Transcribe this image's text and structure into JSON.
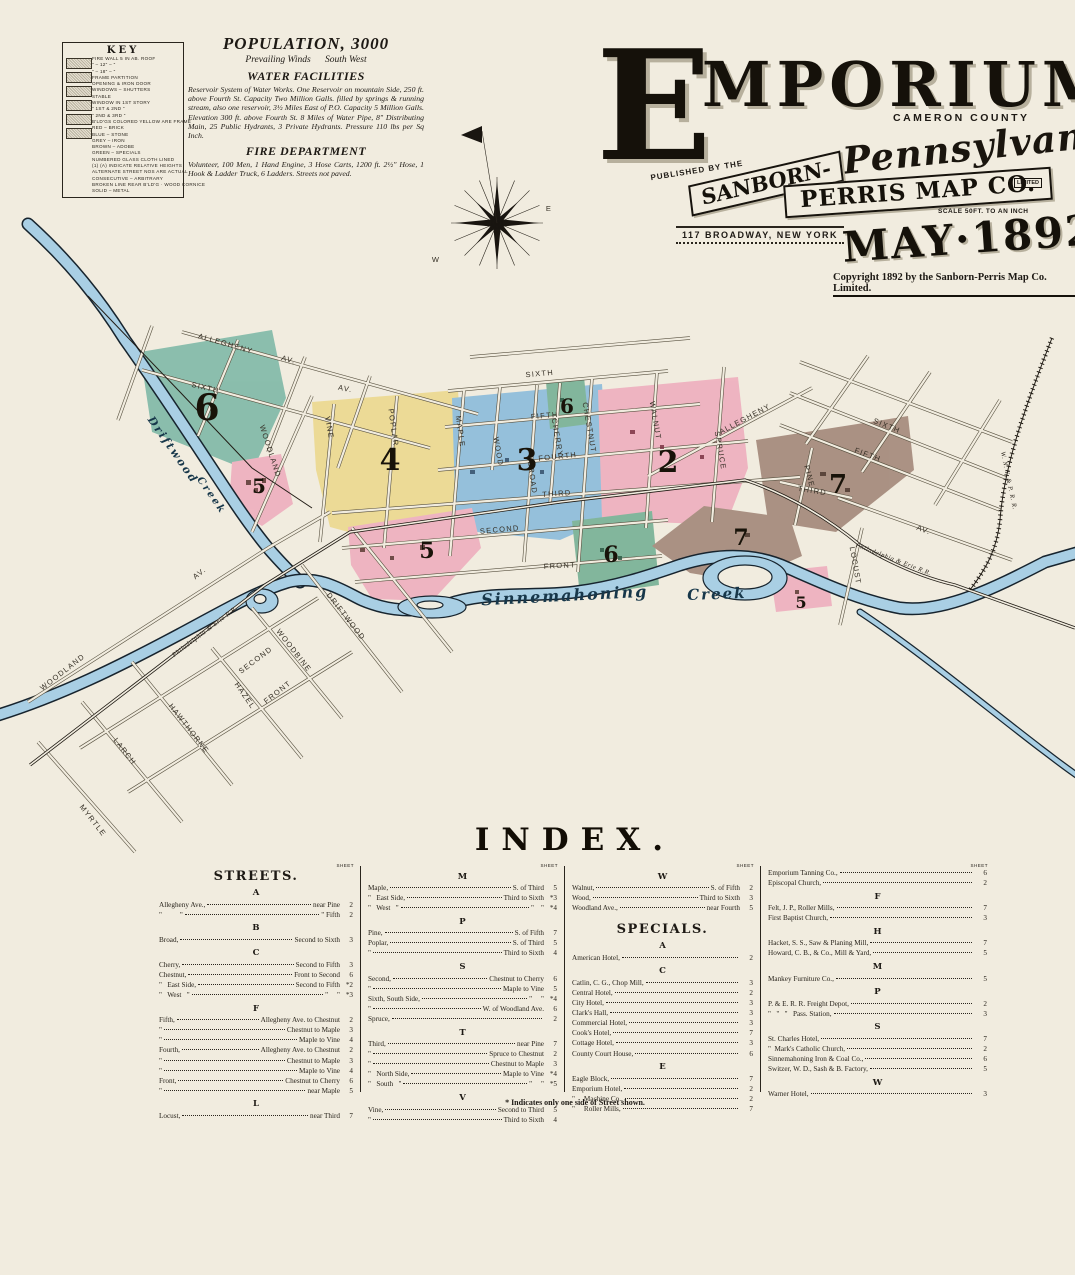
{
  "colors": {
    "paper": "#f1ecdf",
    "teal_district": "#7fb9a7",
    "yellow_district": "#ecd98f",
    "blue_district": "#8cbcdb",
    "pink_district": "#eeafbe",
    "green_district": "#76b195",
    "brown_district": "#a3887a",
    "river_fill": "#a9cfe4",
    "river_outline": "#17242e",
    "street_line": "#57503f",
    "ink": "#1d1914"
  },
  "key": {
    "title": "KEY",
    "lines": [
      "FIRE WALL 5 IN AB. ROOF",
      "\"   –   12\"   –   \"",
      "\"   –   18\"   –   \"",
      "FRAME PARTITION",
      "OPENING & IRON DOOR",
      "WINDOWS  –  SHUTTERS",
      "STABLE",
      "WINDOW IN 1ST STORY",
      "\"   1ST & 2ND   \"",
      "\"   2ND & 3RD   \"",
      "B'LD'GS COLORED YELLOW ARE FRAME",
      "RED   –   BRICK",
      "BLUE   –   STONE",
      "GREY   –   IRON",
      "BROWN   –   ADOBE",
      "GREEN   –   SPECIALS",
      "NUMBERED GLASS CLOTH LINED",
      "(1) (A) INDICATE RELATIVE HEIGHTS",
      "ALTERNATE STREET NOS ARE ACTUAL",
      "CONSECUTIVE   –   ARBITRARY",
      "BROKEN LINE REAR B'LD'G · WOOD CORNICE",
      "SOLID   –   METAL"
    ]
  },
  "info": {
    "population": "POPULATION, 3000",
    "winds": "Prevailing Winds      South West",
    "water_title": "WATER FACILITIES",
    "water_text": "Reservoir System of Water Works. One Reservoir on mountain Side, 250 ft. above Fourth St. Capacity Two Million Galls. filled by springs & running stream, also one reservoir, 3½ Miles East of P.O. Capacity 5 Million Galls. Elevation 300 ft. above Fourth St. 8 Miles of Water Pipe, 8\" Distributing Main, 25 Public Hydrants, 3 Private Hydrants. Pressure 110 lbs per Sq Inch.",
    "fire_title": "FIRE DEPARTMENT",
    "fire_text": "Volunteer, 100 Men, 1 Hand Engine, 3 Hose Carts, 1200 ft. 2½\" Hose, 1 Hook & Ladder Truck, 6 Ladders. Streets not paved."
  },
  "title_block": {
    "city_initial": "E",
    "city_rest": "MPORIUM",
    "county": "CAMERON COUNTY",
    "state": "Pennsylvania",
    "published_by": "PUBLISHED BY THE",
    "publisher_top": "SANBORN-",
    "publisher_bottom": "PERRIS MAP CO.",
    "limited": "LIMITED",
    "address": "117 BROADWAY, NEW YORK",
    "scale": "SCALE 50FT. TO AN INCH",
    "date": "MAY·1892",
    "copyright": "Copyright 1892 by the Sanborn-Perris Map Co. Limited."
  },
  "map": {
    "street_labels": [
      {
        "t": "ALLEGHENY",
        "x": 225,
        "y": 346,
        "r": 16
      },
      {
        "t": "AV.",
        "x": 288,
        "y": 362,
        "r": 16
      },
      {
        "t": "SIXTH",
        "x": 205,
        "y": 390,
        "r": 13
      },
      {
        "t": "AV.",
        "x": 345,
        "y": 391,
        "r": 11
      },
      {
        "t": "WOODLAND",
        "x": 268,
        "y": 452,
        "r": 72
      },
      {
        "t": "VINE",
        "x": 327,
        "y": 428,
        "r": 80
      },
      {
        "t": "POPLAR",
        "x": 391,
        "y": 428,
        "r": 82
      },
      {
        "t": "MAPLE",
        "x": 458,
        "y": 432,
        "r": 82
      },
      {
        "t": "SIXTH",
        "x": 540,
        "y": 376,
        "r": -5,
        "fs": 8.5
      },
      {
        "t": "FIFTH",
        "x": 545,
        "y": 418,
        "r": -5,
        "fs": 8.5
      },
      {
        "t": "WOOD",
        "x": 496,
        "y": 452,
        "r": 80,
        "fs": 6.5
      },
      {
        "t": "BROAD",
        "x": 530,
        "y": 478,
        "r": 82
      },
      {
        "t": "CHERRY",
        "x": 555,
        "y": 438,
        "r": 80,
        "fs": 6.5
      },
      {
        "t": "FOURTH",
        "x": 558,
        "y": 459,
        "r": -6,
        "fs": 8.5
      },
      {
        "t": "THIRD",
        "x": 557,
        "y": 496,
        "r": -4,
        "fs": 8.5
      },
      {
        "t": "CHESTNUT",
        "x": 587,
        "y": 428,
        "r": 80
      },
      {
        "t": "WALNUT",
        "x": 653,
        "y": 421,
        "r": 80
      },
      {
        "t": "SPRUCE",
        "x": 718,
        "y": 451,
        "r": 80
      },
      {
        "t": "ALLEGHENY",
        "x": 746,
        "y": 421,
        "r": -28
      },
      {
        "t": "SECOND",
        "x": 500,
        "y": 532,
        "r": -5,
        "fs": 8.5
      },
      {
        "t": "FRONT",
        "x": 560,
        "y": 568,
        "r": -3,
        "fs": 8.5
      },
      {
        "t": "SIXTH",
        "x": 886,
        "y": 428,
        "r": 22
      },
      {
        "t": "FIFTH",
        "x": 867,
        "y": 457,
        "r": 20
      },
      {
        "t": "PINE",
        "x": 807,
        "y": 477,
        "r": 75
      },
      {
        "t": "THIRD",
        "x": 812,
        "y": 493,
        "r": 9
      },
      {
        "t": "AV.",
        "x": 923,
        "y": 532,
        "r": 20
      },
      {
        "t": "LOCUST",
        "x": 853,
        "y": 566,
        "r": 80
      },
      {
        "t": "DRIFTWOOD",
        "x": 344,
        "y": 618,
        "r": 52
      },
      {
        "t": "SECOND",
        "x": 257,
        "y": 662,
        "r": -37
      },
      {
        "t": "WOODBINE",
        "x": 292,
        "y": 652,
        "r": 52
      },
      {
        "t": "HAZEL",
        "x": 243,
        "y": 697,
        "r": 55
      },
      {
        "t": "FRONT",
        "x": 279,
        "y": 694,
        "r": -38
      },
      {
        "t": "HAWTHORNE",
        "x": 187,
        "y": 730,
        "r": 52
      },
      {
        "t": "LARCH",
        "x": 123,
        "y": 753,
        "r": 52
      },
      {
        "t": "MYRTLE",
        "x": 91,
        "y": 822,
        "r": 52
      },
      {
        "t": "WOODLAND",
        "x": 64,
        "y": 674,
        "r": -38
      },
      {
        "t": "AV.",
        "x": 201,
        "y": 575,
        "r": -38
      },
      {
        "t": "W",
        "x": 436,
        "y": 262,
        "r": 0,
        "fs": 6
      },
      {
        "t": "E",
        "x": 549,
        "y": 211,
        "r": 0,
        "fs": 6
      }
    ],
    "rail_labels": [
      {
        "t": "Philadelphia & Erie R.R.",
        "x": 206,
        "y": 633,
        "r": -37
      },
      {
        "t": "Philadelphia & Erie R.R.",
        "x": 893,
        "y": 561,
        "r": 21
      },
      {
        "t": "W. N. Y. & P. R. R.",
        "x": 1007,
        "y": 481,
        "r": 78
      }
    ],
    "water_labels": [
      {
        "t": "Driftwood",
        "x": 170,
        "y": 452,
        "r": 55,
        "fs": 11
      },
      {
        "t": "Creek",
        "x": 209,
        "y": 497,
        "r": 55,
        "fs": 10
      },
      {
        "t": "Sinnemahoning",
        "x": 565,
        "y": 601,
        "r": -3,
        "fs": 16
      },
      {
        "t": "Creek",
        "x": 717,
        "y": 599,
        "r": -2,
        "fs": 15
      }
    ],
    "district_labels": [
      {
        "t": "6",
        "x": 207,
        "y": 420,
        "fs": 36
      },
      {
        "t": "4",
        "x": 390,
        "y": 470,
        "fs": 30
      },
      {
        "t": "3",
        "x": 527,
        "y": 470,
        "fs": 30
      },
      {
        "t": "2",
        "x": 668,
        "y": 472,
        "fs": 30
      },
      {
        "t": "6",
        "x": 567,
        "y": 413,
        "fs": 20
      },
      {
        "t": "5",
        "x": 259,
        "y": 493,
        "fs": 20
      },
      {
        "t": "5",
        "x": 427,
        "y": 558,
        "fs": 22
      },
      {
        "t": "6",
        "x": 611,
        "y": 562,
        "fs": 22
      },
      {
        "t": "7",
        "x": 838,
        "y": 493,
        "fs": 26
      },
      {
        "t": "7",
        "x": 741,
        "y": 545,
        "fs": 22
      },
      {
        "t": "5",
        "x": 801,
        "y": 608,
        "fs": 16
      }
    ]
  },
  "index": {
    "title": "INDEX.",
    "sheet_header": "SHEET",
    "footnote": "* Indicates only one side of Street shown.",
    "columns": [
      {
        "header": "STREETS.",
        "sections": [
          {
            "letter": "A",
            "entries": [
              {
                "n": "Allegheny Ave.,",
                "d": "near Pine",
                "s": "2"
              },
              {
                "n": "\"          \"",
                "d": "\" Fifth",
                "s": "2"
              }
            ]
          },
          {
            "letter": "B",
            "entries": [
              {
                "n": "Broad,",
                "d": "Second to Sixth",
                "s": "3"
              }
            ]
          },
          {
            "letter": "C",
            "entries": [
              {
                "n": "Cherry,",
                "d": "Second to Fifth",
                "s": "3"
              },
              {
                "n": "Chestnut,",
                "d": "Front to Second",
                "s": "6"
              },
              {
                "n": "\"   East Side,",
                "d": "Second to Fifth",
                "s": "*2"
              },
              {
                "n": "\"   West   \"",
                "d": "\"     \"",
                "s": "*3"
              }
            ]
          },
          {
            "letter": "F",
            "entries": [
              {
                "n": "Fifth,",
                "d": "Allegheny Ave. to Chestnut",
                "s": "2"
              },
              {
                "n": "\"",
                "d": "Chestnut to Maple",
                "s": "3"
              },
              {
                "n": "\"",
                "d": "Maple to Vine",
                "s": "4"
              },
              {
                "n": "Fourth,",
                "d": "Allegheny Ave. to Chestnut",
                "s": "2"
              },
              {
                "n": "\"",
                "d": "Chestnut to Maple",
                "s": "3"
              },
              {
                "n": "\"",
                "d": "Maple to Vine",
                "s": "4"
              },
              {
                "n": "Front,",
                "d": "Chestnut to Cherry",
                "s": "6"
              },
              {
                "n": "\"",
                "d": "near Maple",
                "s": "5"
              }
            ]
          },
          {
            "letter": "L",
            "entries": [
              {
                "n": "Locust,",
                "d": "near Third",
                "s": "7"
              }
            ]
          }
        ]
      },
      {
        "sections": [
          {
            "letter": "M",
            "entries": [
              {
                "n": "Maple,",
                "d": "S. of Third",
                "s": "5"
              },
              {
                "n": "\"   East Side,",
                "d": "Third to Sixth",
                "s": "*3"
              },
              {
                "n": "\"   West   \"",
                "d": "\"    \"",
                "s": "*4"
              }
            ]
          },
          {
            "letter": "P",
            "entries": [
              {
                "n": "Pine,",
                "d": "S. of Fifth",
                "s": "7"
              },
              {
                "n": "Poplar,",
                "d": "S. of Third",
                "s": "5"
              },
              {
                "n": "\"",
                "d": "Third to Sixth",
                "s": "4"
              }
            ]
          },
          {
            "letter": "S",
            "entries": [
              {
                "n": "Second,",
                "d": "Chestnut to Cherry",
                "s": "6"
              },
              {
                "n": "\"",
                "d": "Maple to Vine",
                "s": "5"
              },
              {
                "n": "Sixth, South Side,",
                "d": "\"     \"",
                "s": "*4"
              },
              {
                "n": "\"",
                "d": "W. of Woodland Ave.",
                "s": "6"
              },
              {
                "n": "Spruce,",
                "d": "",
                "s": "2"
              }
            ]
          },
          {
            "letter": "T",
            "entries": [
              {
                "n": "Third,",
                "d": "near Pine",
                "s": "7"
              },
              {
                "n": "\"",
                "d": "Spruce to Chestnut",
                "s": "2"
              },
              {
                "n": "\"",
                "d": "Chestnut to Maple",
                "s": "3"
              },
              {
                "n": "\"   North Side,",
                "d": "Maple to Vine",
                "s": "*4"
              },
              {
                "n": "\"   South   \"",
                "d": "\"     \"",
                "s": "*5"
              }
            ]
          },
          {
            "letter": "V",
            "entries": [
              {
                "n": "Vine,",
                "d": "Second to Third",
                "s": "5"
              },
              {
                "n": "\"",
                "d": "Third to Sixth",
                "s": "4"
              }
            ]
          }
        ]
      },
      {
        "sections": [
          {
            "letter": "W",
            "entries": [
              {
                "n": "Walnut,",
                "d": "S. of Fifth",
                "s": "2"
              },
              {
                "n": "Wood,",
                "d": "Third to Sixth",
                "s": "3"
              },
              {
                "n": "Woodland Ave.,",
                "d": "near Fourth",
                "s": "5"
              }
            ]
          },
          {
            "group_header": "SPECIALS.",
            "letter": "A",
            "entries": [
              {
                "n": "American Hotel,",
                "d": "",
                "s": "2"
              }
            ]
          },
          {
            "letter": "C",
            "entries": [
              {
                "n": "Catlin, C. G., Chop Mill,",
                "d": "",
                "s": "3"
              },
              {
                "n": "Central Hotel,",
                "d": "",
                "s": "2"
              },
              {
                "n": "City Hotel,",
                "d": "",
                "s": "3"
              },
              {
                "n": "Clark's Hall,",
                "d": "",
                "s": "3"
              },
              {
                "n": "Commercial Hotel,",
                "d": "",
                "s": "3"
              },
              {
                "n": "Cook's Hotel,",
                "d": "",
                "s": "7"
              },
              {
                "n": "Cottage Hotel,",
                "d": "",
                "s": "3"
              },
              {
                "n": "County Court House,",
                "d": "",
                "s": "6"
              }
            ]
          },
          {
            "letter": "E",
            "entries": [
              {
                "n": "Eagle Block,",
                "d": "",
                "s": "7"
              },
              {
                "n": "Emporium Hotel,",
                "d": "",
                "s": "2"
              },
              {
                "n": "\"     Machine Co.,",
                "d": "",
                "s": "2"
              },
              {
                "n": "\"     Roller Mills,",
                "d": "",
                "s": "7"
              }
            ]
          }
        ]
      },
      {
        "sections": [
          {
            "entries": [
              {
                "n": "Emporium Tanning Co.,",
                "d": "",
                "s": "6"
              },
              {
                "n": "Episcopal Church,",
                "d": "",
                "s": "2"
              }
            ]
          },
          {
            "letter": "F",
            "entries": [
              {
                "n": "Felt, J. P., Roller Mills,",
                "d": "",
                "s": "7"
              },
              {
                "n": "First Baptist Church,",
                "d": "",
                "s": "3"
              }
            ]
          },
          {
            "letter": "H",
            "entries": [
              {
                "n": "Hacket, S. S., Saw & Planing Mill,",
                "d": "",
                "s": "7"
              },
              {
                "n": "Howard, C. B., & Co., Mill & Yard,",
                "d": "",
                "s": "5"
              }
            ]
          },
          {
            "letter": "M",
            "entries": [
              {
                "n": "Mankey Furniture Co.,",
                "d": "",
                "s": "5"
              }
            ]
          },
          {
            "letter": "P",
            "entries": [
              {
                "n": "P. & E. R. R. Freight Depot,",
                "d": "",
                "s": "2"
              },
              {
                "n": "\"   \"   \"   Pass. Station,",
                "d": "",
                "s": "3"
              }
            ]
          },
          {
            "letter": "S",
            "entries": [
              {
                "n": "St. Charles Hotel,",
                "d": "",
                "s": "7"
              },
              {
                "n": "\"  Mark's Catholic Church,",
                "d": "",
                "s": "2"
              },
              {
                "n": "Sinnemahoning Iron & Coal Co.,",
                "d": "",
                "s": "6"
              },
              {
                "n": "Switzer, W. D., Sash & B. Factory,",
                "d": "",
                "s": "5"
              }
            ]
          },
          {
            "letter": "W",
            "entries": [
              {
                "n": "Warner Hotel,",
                "d": "",
                "s": "3"
              }
            ]
          }
        ]
      }
    ]
  }
}
